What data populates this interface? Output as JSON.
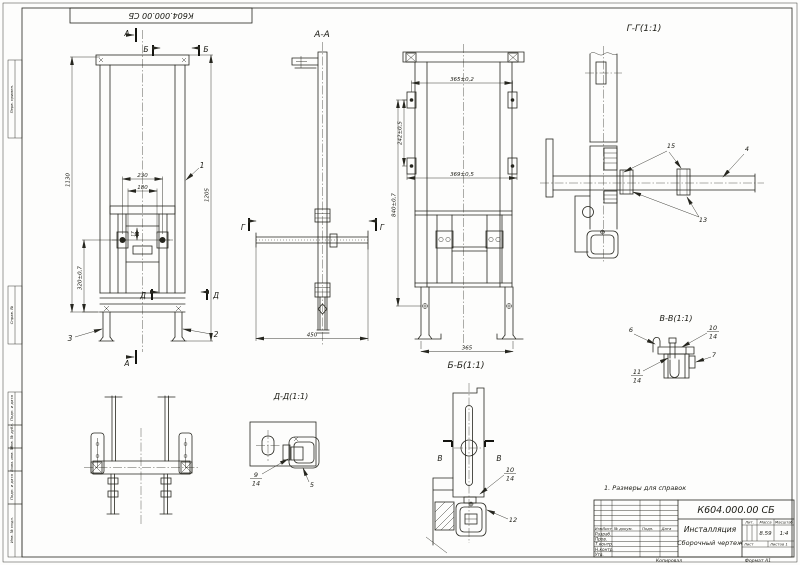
{
  "sheet": {
    "corner_stamp": "К604.000.00 СБ",
    "note": "1. Размеры для справок",
    "copied": "Копировал",
    "format": "Формат А1"
  },
  "border": {
    "perv_primen": "Перв. примен.",
    "sprav_no": "Справ. №",
    "podp_data_1": "Подп. и дата",
    "inv_dubl": "Инв. № дубл.",
    "vzam_inv": "Взам. инв. №",
    "podp_data_2": "Подп. и дата",
    "inv_podl": "Инв. № подл."
  },
  "front": {
    "callout_1": "1",
    "callout_2": "2",
    "callout_3": "3",
    "dim_230": "230",
    "dim_180": "180",
    "dim_17": "17",
    "dim_1130": "1130",
    "dim_320": "320±0,7",
    "dim_1205": "1205",
    "mark_a": "А",
    "mark_b": "Б",
    "mark_d": "Д"
  },
  "section_aa": {
    "title": "А-А",
    "dim_450": "450",
    "mark_g": "Г"
  },
  "section_bb": {
    "title": "Б-Б(1:1)",
    "dim_365_02": "365±0,2",
    "dim_242": "242±0,5",
    "dim_369": "369±0,5",
    "dim_840": "840±0,7",
    "dim_365": "365"
  },
  "section_gg": {
    "title": "Г-Г(1:1)",
    "callout_15": "15",
    "callout_4": "4",
    "callout_13": "13"
  },
  "section_vv": {
    "title": "В-В(1:1)",
    "callout_6": "6",
    "callout_7": "7",
    "callout_10_num": "10",
    "callout_10_den": "14",
    "callout_11_num": "11",
    "callout_11_den": "14"
  },
  "section_dd": {
    "title": "Д-Д(1:1)",
    "callout_9_num": "9",
    "callout_9_den": "14",
    "callout_5": "5"
  },
  "foot_detail": {
    "mark_v": "В",
    "callout_10_num": "10",
    "callout_10_den": "14",
    "callout_12": "12"
  },
  "title_block": {
    "designation": "К604.000.00 СБ",
    "name": "Инсталляция",
    "doc_type": "Сборочный чертеж",
    "h_izm": "Изм.",
    "h_list": "Лист",
    "h_dokum": "№ докум.",
    "h_podp": "Подп.",
    "h_data": "Дата",
    "r_razrab": "Разраб.",
    "r_prov": "Пров.",
    "r_tkontr": "Т.контр.",
    "r_nkontr": "Н.контр.",
    "r_utv": "Утв.",
    "h_lit": "Лит.",
    "h_massa": "Масса",
    "h_masshtab": "Масштаб",
    "v_massa": "8.59",
    "v_masshtab": "1:4",
    "h_list2": "Лист",
    "h_listov": "Листов 1"
  }
}
